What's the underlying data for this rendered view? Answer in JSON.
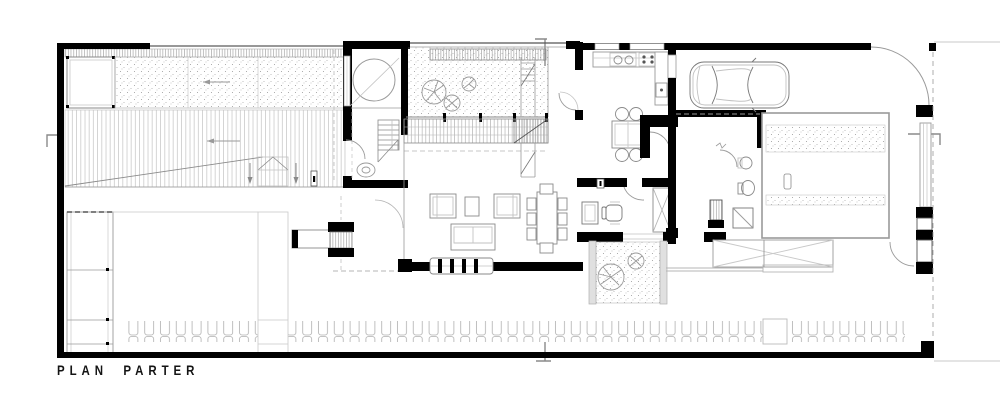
{
  "title": {
    "label": "PLAN PARTER"
  },
  "colors": {
    "background": "#ffffff",
    "wall": "#000000",
    "line": "#8a8a8a",
    "light_line": "#c2c2c2",
    "text": "#141414"
  }
}
